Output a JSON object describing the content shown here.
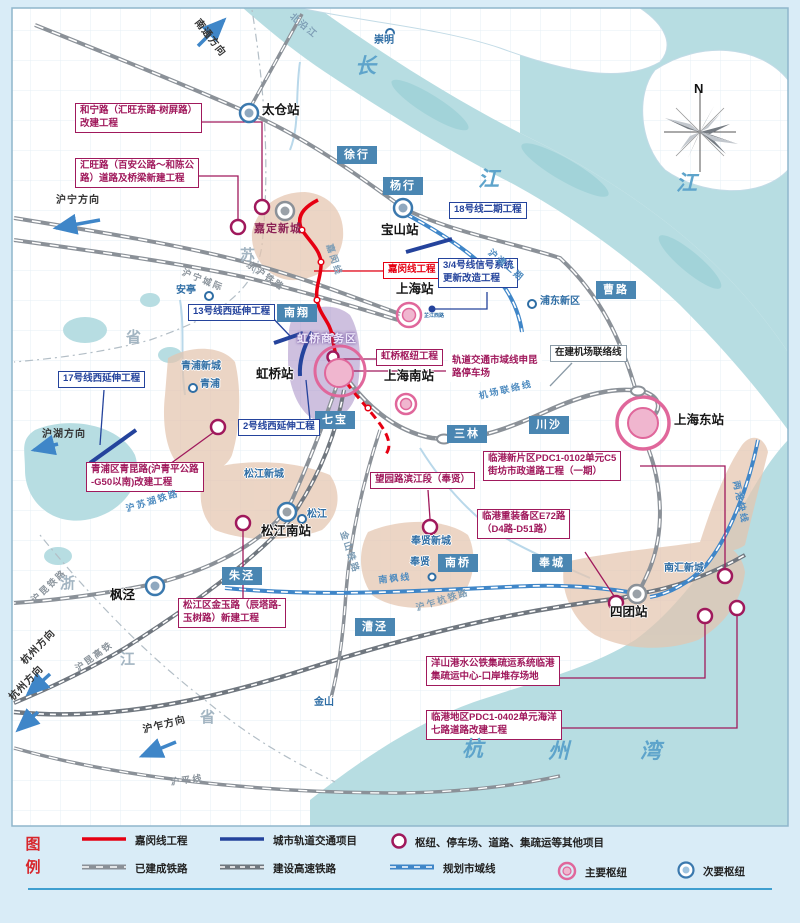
{
  "colors": {
    "red": "#e60012",
    "magenta": "#a0195c",
    "blue": "#24439c",
    "planned": "#3f86c8",
    "rail": "#8b9198",
    "town_bg": "#4a86b2",
    "hub_pink": "#e0679b",
    "hub_fill": "#f0b6cf",
    "minor_blue": "#3b79ae",
    "water": "#b7dde2",
    "tan": "#e4c5af",
    "purple": "#a58cc4"
  },
  "compass": {
    "north": "N"
  },
  "map": {
    "towns": [
      {
        "name": "徐行",
        "x": 337,
        "y": 146
      },
      {
        "name": "杨行",
        "x": 383,
        "y": 177
      },
      {
        "name": "南翔",
        "x": 277,
        "y": 304
      },
      {
        "name": "七宝",
        "x": 315,
        "y": 411
      },
      {
        "name": "三林",
        "x": 447,
        "y": 425
      },
      {
        "name": "川沙",
        "x": 529,
        "y": 416
      },
      {
        "name": "曹路",
        "x": 596,
        "y": 281
      },
      {
        "name": "朱泾",
        "x": 222,
        "y": 567
      },
      {
        "name": "漕泾",
        "x": 355,
        "y": 618
      },
      {
        "name": "南桥",
        "x": 438,
        "y": 554
      },
      {
        "name": "奉城",
        "x": 532,
        "y": 554
      }
    ],
    "stations": [
      {
        "name": "太仓站",
        "x": 262,
        "y": 104
      },
      {
        "name": "宝山站",
        "x": 381,
        "y": 224
      },
      {
        "name": "上海站",
        "x": 396,
        "y": 283
      },
      {
        "name": "虹桥站",
        "x": 256,
        "y": 368
      },
      {
        "name": "上海南站",
        "x": 384,
        "y": 370
      },
      {
        "name": "上海东站",
        "x": 674,
        "y": 414
      },
      {
        "name": "松江南站",
        "x": 261,
        "y": 525
      },
      {
        "name": "四团站",
        "x": 610,
        "y": 606
      },
      {
        "name": "枫泾",
        "x": 110,
        "y": 589
      }
    ],
    "places": [
      {
        "name": "崇明",
        "x": 374,
        "y": 36
      },
      {
        "name": "安亭",
        "x": 176,
        "y": 286
      },
      {
        "name": "青浦",
        "x": 200,
        "y": 380
      },
      {
        "name": "松江",
        "x": 307,
        "y": 510
      },
      {
        "name": "奉贤",
        "x": 410,
        "y": 558
      },
      {
        "name": "浦东新区",
        "x": 540,
        "y": 297
      },
      {
        "name": "金山",
        "x": 314,
        "y": 698
      },
      {
        "name": "南汇新城",
        "x": 664,
        "y": 564
      },
      {
        "name": "青浦新城",
        "x": 181,
        "y": 362
      },
      {
        "name": "松江新城",
        "x": 244,
        "y": 470
      },
      {
        "name": "奉贤新城",
        "x": 411,
        "y": 537
      }
    ],
    "newtowns": [
      {
        "name": "嘉定新城",
        "x": 254,
        "y": 224,
        "color": "#8c2155"
      },
      {
        "name": "虹桥商务区",
        "x": 297,
        "y": 334,
        "color": "#efe9fb"
      }
    ],
    "projects": [
      {
        "lines": [
          "和宁路（汇旺东路-树屏路）",
          "改建工程"
        ],
        "x": 75,
        "y": 103,
        "color": "magenta"
      },
      {
        "lines": [
          "汇旺路（百安公路～和陈公",
          "路）道路及桥梁新建工程"
        ],
        "x": 75,
        "y": 158,
        "color": "magenta"
      },
      {
        "lines": [
          "嘉闵线工程"
        ],
        "x": 383,
        "y": 262,
        "color": "red"
      },
      {
        "lines": [
          "虹桥枢纽工程"
        ],
        "x": 376,
        "y": 349,
        "color": "magenta"
      },
      {
        "lines": [
          "轨道交通市域线申昆",
          "路停车场"
        ],
        "x": 448,
        "y": 354,
        "color": "magenta",
        "border": false
      },
      {
        "lines": [
          "2号线西延伸工程"
        ],
        "x": 238,
        "y": 419,
        "color": "blue"
      },
      {
        "lines": [
          "13号线西延伸工程"
        ],
        "x": 188,
        "y": 304,
        "color": "blue"
      },
      {
        "lines": [
          "17号线西延伸工程"
        ],
        "x": 58,
        "y": 371,
        "color": "blue"
      },
      {
        "lines": [
          "18号线二期工程"
        ],
        "x": 449,
        "y": 202,
        "color": "blue"
      },
      {
        "lines": [
          "3/4号线信号系统",
          "更新改造工程"
        ],
        "x": 438,
        "y": 258,
        "color": "blue"
      },
      {
        "lines": [
          "青浦区青昆路(沪青平公路",
          "-G50以南)改建工程"
        ],
        "x": 86,
        "y": 462,
        "color": "magenta"
      },
      {
        "lines": [
          "松江区金玉路（辰塔路-",
          "玉树路）新建工程"
        ],
        "x": 178,
        "y": 598,
        "color": "magenta"
      },
      {
        "lines": [
          "望园路滨江段（奉贤）"
        ],
        "x": 370,
        "y": 472,
        "color": "magenta"
      },
      {
        "lines": [
          "临港新片区PDC1-0102单元C5",
          "街坊市政道路工程（一期）"
        ],
        "x": 483,
        "y": 451,
        "color": "magenta"
      },
      {
        "lines": [
          "临港重装备区E72路",
          "（D4路-D51路）"
        ],
        "x": 477,
        "y": 509,
        "color": "magenta"
      },
      {
        "lines": [
          "洋山港水公铁集疏运系统临港",
          "集疏运中心-口岸堆存场地"
        ],
        "x": 426,
        "y": 656,
        "color": "magenta"
      },
      {
        "lines": [
          "临港地区PDC1-0402单元海洋",
          "七路道路改建工程"
        ],
        "x": 426,
        "y": 710,
        "color": "magenta"
      },
      {
        "lines": [
          "在建机场联络线"
        ],
        "x": 550,
        "y": 345,
        "color": "plain"
      }
    ],
    "railway_names": [
      {
        "name": "京沪铁路",
        "x": 250,
        "y": 260,
        "rot": 35,
        "color": "#8b949c"
      },
      {
        "name": "沪宁城际",
        "x": 184,
        "y": 268,
        "rot": 22,
        "color": "#8b949c"
      },
      {
        "name": "嘉闵线",
        "x": 333,
        "y": 243,
        "rot": 72,
        "color": "#7d9db5"
      },
      {
        "name": "沪通二期",
        "x": 492,
        "y": 248,
        "rot": 40,
        "color": "#4f8cc0"
      },
      {
        "name": "机场联络线",
        "x": 478,
        "y": 392,
        "rot": -13,
        "color": "#4f8cc0"
      },
      {
        "name": "沪苏湖铁路",
        "x": 125,
        "y": 505,
        "rot": -17,
        "color": "#4f8cc0"
      },
      {
        "name": "金山铁路",
        "x": 347,
        "y": 530,
        "rot": 72,
        "color": "#7d9db5"
      },
      {
        "name": "南枫线",
        "x": 378,
        "y": 576,
        "rot": -6,
        "color": "#4f8cc0"
      },
      {
        "name": "沪乍杭铁路",
        "x": 415,
        "y": 604,
        "rot": -17,
        "color": "#7d9db5"
      },
      {
        "name": "沪昆铁路",
        "x": 30,
        "y": 598,
        "rot": -43,
        "color": "#8b949c"
      },
      {
        "name": "沪昆高铁",
        "x": 74,
        "y": 666,
        "rot": -36,
        "color": "#8b949c"
      },
      {
        "name": "沪平线",
        "x": 170,
        "y": 778,
        "rot": -7,
        "color": "#8b949c"
      },
      {
        "name": "两港快线",
        "x": 740,
        "y": 480,
        "rot": 78,
        "color": "#4f8cc0"
      },
      {
        "name": "北沿江",
        "x": 294,
        "y": 12,
        "rot": 40,
        "color": "#7d9db5"
      }
    ],
    "directions": [
      {
        "name": "南通方向",
        "x": 200,
        "y": 18,
        "rot": 52
      },
      {
        "name": "沪宁方向",
        "x": 56,
        "y": 196,
        "rot": 0
      },
      {
        "name": "沪湖方向",
        "x": 42,
        "y": 430,
        "rot": 0
      },
      {
        "name": "杭州方向",
        "x": 20,
        "y": 660,
        "rot": -46
      },
      {
        "name": "杭州方向",
        "x": 8,
        "y": 696,
        "rot": -46
      },
      {
        "name": "沪乍方向",
        "x": 142,
        "y": 726,
        "rot": -14
      }
    ],
    "water_names": [
      {
        "char": "长",
        "x": 355,
        "y": 55
      },
      {
        "char": "江",
        "x": 478,
        "y": 168
      },
      {
        "char": "江",
        "x": 676,
        "y": 172
      },
      {
        "char": "杭",
        "x": 462,
        "y": 738
      },
      {
        "char": "州",
        "x": 548,
        "y": 740
      },
      {
        "char": "湾",
        "x": 640,
        "y": 740
      }
    ],
    "province_names": [
      {
        "char": "苏",
        "x": 240,
        "y": 248
      },
      {
        "char": "省",
        "x": 126,
        "y": 330
      },
      {
        "char": "浙",
        "x": 60,
        "y": 576
      },
      {
        "char": "江",
        "x": 120,
        "y": 652
      },
      {
        "char": "省",
        "x": 200,
        "y": 710
      }
    ],
    "small_texts": [
      {
        "text": "芷江西路",
        "x": 424,
        "y": 314
      }
    ]
  },
  "legend": {
    "title": "图例",
    "rows": [
      [
        {
          "type": "red-line",
          "label": "嘉闵线工程",
          "x": 80
        },
        {
          "type": "blue-line",
          "label": "城市轨道交通项目",
          "x": 218
        },
        {
          "type": "ring",
          "label": "枢纽、停车场、道路、集疏运等其他项目",
          "x": 390
        }
      ],
      [
        {
          "type": "rail",
          "label": "已建成铁路",
          "x": 80
        },
        {
          "type": "rail2",
          "label": "建设高速铁路",
          "x": 218
        },
        {
          "type": "planned",
          "label": "规划市域线",
          "x": 388
        },
        {
          "type": "major",
          "label": "主要枢纽",
          "x": 556
        },
        {
          "type": "minor",
          "label": "次要枢纽",
          "x": 676
        }
      ]
    ]
  }
}
